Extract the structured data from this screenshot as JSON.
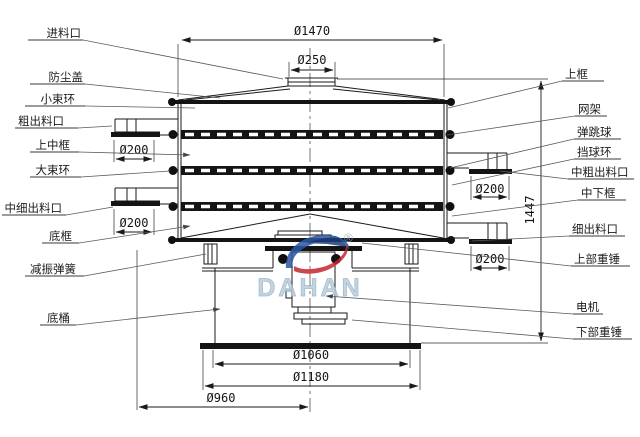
{
  "labels": {
    "left": [
      "进料口",
      "防尘盖",
      "小束环",
      "粗出料口",
      "上中框",
      "大束环",
      "中细出料口",
      "底框",
      "减振弹簧",
      "底桶"
    ],
    "right": [
      "上框",
      "网架",
      "弹跳球",
      "挡球环",
      "中粗出料口",
      "中下框",
      "细出料口",
      "上部重锤",
      "电机",
      "下部重锤"
    ]
  },
  "dims": {
    "top_outer": "Ø1470",
    "inlet": "Ø250",
    "outlet": "Ø200",
    "height": "1447",
    "base_inner": "Ø1060",
    "base_outer": "Ø1180",
    "base_left": "Ø960"
  },
  "watermark": {
    "brand": "DAHAN",
    "registered": "®"
  },
  "colors": {
    "line": "#1a1a1a",
    "wm_blue": "#2a57a5",
    "wm_navy": "#1b3f7e",
    "wm_red": "#c4272e",
    "wm_text": "#b9cdda",
    "wm_mark": "#9ab3c4"
  }
}
